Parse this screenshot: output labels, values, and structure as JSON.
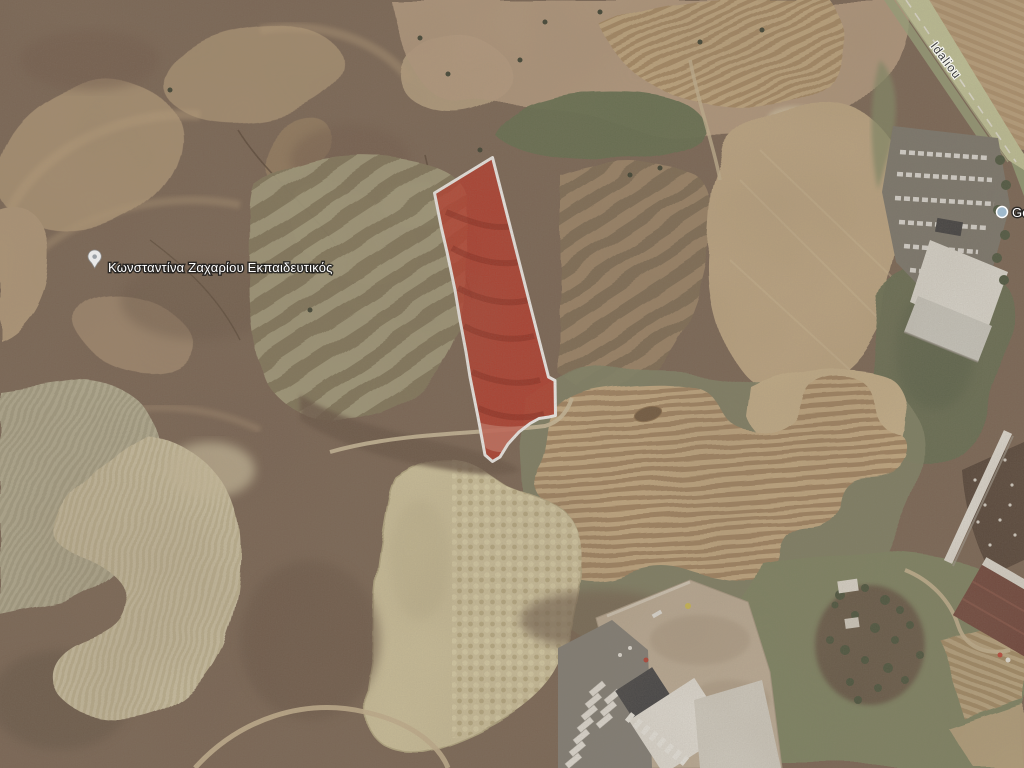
{
  "map": {
    "view_type": "satellite",
    "parcel": {
      "fill": "#bf2a1b",
      "stroke": "#ffffff",
      "description": "highlighted land parcel outline"
    },
    "pois": [
      {
        "label": "Κωνσταντίνα Ζαχαρίου Εκπαιδευτικός",
        "icon": "map-pin"
      },
      {
        "label": "Golden",
        "icon": "map-pin"
      }
    ],
    "roads": [
      {
        "label": "Idaliou"
      }
    ]
  }
}
